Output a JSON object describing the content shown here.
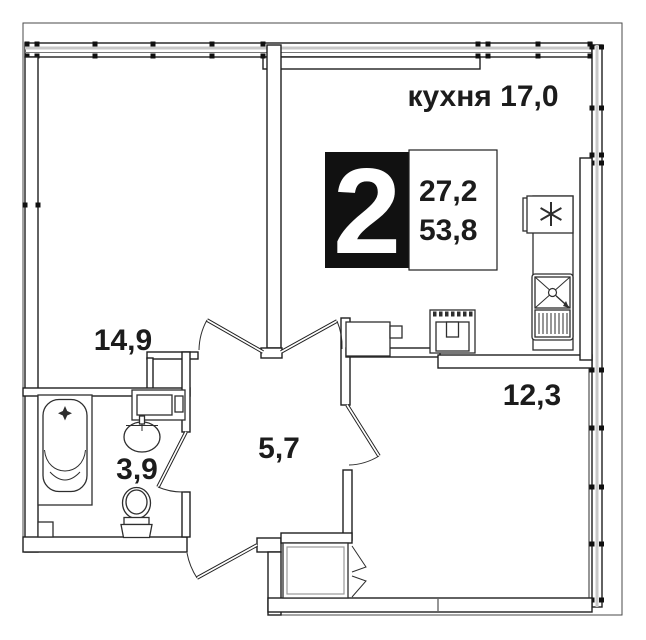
{
  "floorplan": {
    "badge": {
      "rooms_number": "2",
      "area_line1": "27,2",
      "area_line2": "53,8"
    },
    "labels": {
      "kitchen": "кухня 17,0",
      "living": "14,9",
      "bathroom": "3,9",
      "hallway": "5,7",
      "room": "12,3"
    },
    "colors": {
      "background": "#ffffff",
      "wall_line": "#1f1f1f",
      "fixture_line": "#2e2e2e",
      "glazing": "#c8c8c8",
      "badge_bg": "#111111",
      "badge_text": "#ffffff",
      "label_text": "#1c1c1c"
    },
    "icons": {
      "stove": "six-spoke-burner-asterisk",
      "sink": "cross-box-sink-with-drainboard",
      "bathtub": "bathtub-with-drain-star",
      "washbasin": "oval-washbasin",
      "toilet": "toilet",
      "washer": "appliance-box",
      "wardrobe": "bifold-door-chevrons",
      "doors": "quarter-circle-door-swings",
      "windows": "glazing-band-with-mullions"
    }
  }
}
